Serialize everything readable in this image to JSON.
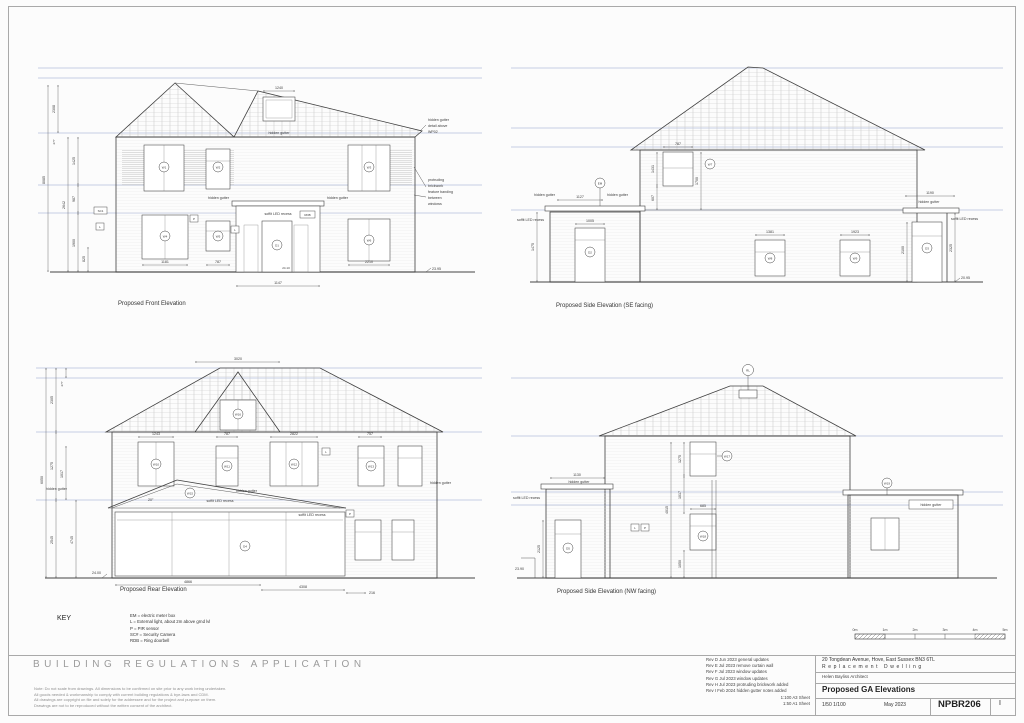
{
  "bottom": {
    "application_title": "BUILDING REGULATIONS APPLICATION",
    "notes": [
      "Note:  Do not scale from drawings. All dimensions to be confirmed on site prior to any work being undertaken.",
      "All goods needed & workmanship to comply with current building regulations & bye-laws and CDM.",
      "All drawings are copyright on file and solely for the addressee and for the project and purpose on them.",
      "Drawings are not to be reproduced without the written consent of the architect."
    ],
    "key": {
      "title": "KEY",
      "items": [
        "EM  = electric meter box",
        "L   = External light, about 2m above grnd lvl",
        "P   = PIR sensor",
        "SC# = Security Camera",
        "RDB = Ring doorbell"
      ]
    },
    "revisions": [
      "Rev D  Jun 2023  general updates",
      "Rev E  Jul 2023  remove curtain wall",
      "Rev F  Jul 2023  window updates",
      "Rev G  Jul 2023  window updates",
      "Rev H  Jul 2023  protruding brickwork added",
      "Rev I  Feb 2024  hidden gutter notes added"
    ],
    "sheet_scales": [
      "1:100  A3 Sheet",
      "1:50  A1 Sheet"
    ],
    "title_block": {
      "address": "20 Tongdean Avenue, Hove, East Sussex  BN3 6TL",
      "project": "Replacement Dwelling",
      "architect": "Helen Bayliss Architect",
      "drawing_title": "Proposed GA Elevations",
      "scale": "1/50   1/100",
      "date": "May 2023",
      "number": "NPBR206",
      "revision": "I"
    },
    "scale_bar": [
      "0m",
      "1m",
      "2m",
      "3m",
      "4m",
      "5m"
    ]
  },
  "common": {
    "hidden_gutter": "hidden gutter",
    "soffit": "soffit LED recess"
  },
  "front": {
    "caption": "Proposed Front Elevation",
    "gutter_note": [
      "hidden gutter",
      "detail above",
      "WP02"
    ],
    "brick_note": [
      "protruding",
      "brickwork",
      "feature banding",
      "between",
      "windows"
    ],
    "dims": {
      "top": "1240",
      "w1": "1181",
      "w2": "787",
      "w3": "2210",
      "bay": "1147",
      "lvl_door": "24.10",
      "lvl_right": "23.95"
    },
    "left_dims": [
      "8085",
      "2308",
      "277",
      "2642",
      "1425",
      "987",
      "1900",
      "825"
    ],
    "tags": [
      "W1",
      "W2",
      "W3",
      "W4",
      "W5",
      "W6",
      "D1"
    ],
    "boxes": [
      "SC1",
      "L",
      "P",
      "L",
      "RDB"
    ]
  },
  "se": {
    "caption": "Proposed Side Elevation (SE facing)",
    "dims": {
      "d1": "1127",
      "d2": "1005",
      "d3": "787",
      "d4": "1431",
      "d5": "607",
      "d6": "1700",
      "d7": "1381",
      "d8": "1923",
      "d9": "1190",
      "d10": "2100",
      "d11": "2325",
      "d12": "1475",
      "lvl": "20.95"
    },
    "tags": [
      "EM",
      "W7",
      "W8",
      "W9",
      "D2",
      "D3"
    ]
  },
  "rear": {
    "caption": "Proposed Rear Elevation",
    "dims": {
      "top": "3020",
      "r1": "1243",
      "r2": "787",
      "r3": "2822",
      "r4": "757",
      "b1": "4866",
      "b2": "4308",
      "b3": "216",
      "angle": "20°",
      "lvl": "24.00"
    },
    "left_dims": [
      "6050",
      "2305",
      "1275",
      "2545",
      "277",
      "1017",
      "4745"
    ],
    "tags": [
      "W10",
      "W11",
      "W12",
      "W13",
      "W16",
      "D4",
      "W15"
    ],
    "boxes": [
      "L",
      "P"
    ]
  },
  "nw": {
    "caption": "Proposed Side Elevation (NW facing)",
    "dims": {
      "d1": "1130",
      "d2": "2125",
      "d3": "1275",
      "d4": "1017",
      "d5": "685",
      "d6": "1050",
      "d7": "4015",
      "lvl": "23.90"
    },
    "tags": [
      "RL",
      "W17",
      "W18",
      "D5",
      "W19"
    ],
    "boxes": [
      "L",
      "P"
    ]
  }
}
